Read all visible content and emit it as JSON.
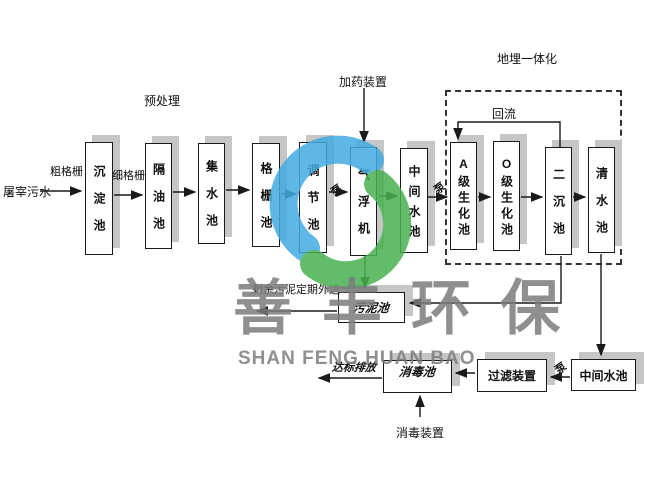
{
  "labels": {
    "influent": "屠宰污水",
    "coarse_screen": "粗格栅",
    "fine_screen": "细格栅",
    "pretreatment": "预处理",
    "dosing_device": "加药装置",
    "buried_integration": "地埋一体化",
    "reflux": "回流",
    "pump": "泵",
    "sludge_removal": "剩余污泥定期外运",
    "discharge": "达标排放",
    "disinfection_device": "消毒装置"
  },
  "boxes": {
    "sedimentation": "沉淀池",
    "oil_separation": "隔油池",
    "collection": "集水池",
    "screen_tank": "格栅池",
    "regulation": "调节池",
    "air_flotation": "气浮机",
    "intermediate": "中间水池",
    "a_bio": "A级生化池",
    "o_bio": "O级生化池",
    "secondary_sed": "二沉池",
    "clear_water": "清水池",
    "sludge": "污泥池",
    "disinfection": "消毒池",
    "filter": "过滤装置",
    "intermediate2": "中间水池"
  },
  "watermark": {
    "cn": "善丰环保",
    "en": "SHAN FENG HUAN BAO",
    "logo_blue": "#42abe1",
    "logo_green": "#47b150",
    "text_gray": "#7c7c7c"
  },
  "colors": {
    "box_shadow": "#c6c6c6",
    "line": "#1a1a1a"
  }
}
